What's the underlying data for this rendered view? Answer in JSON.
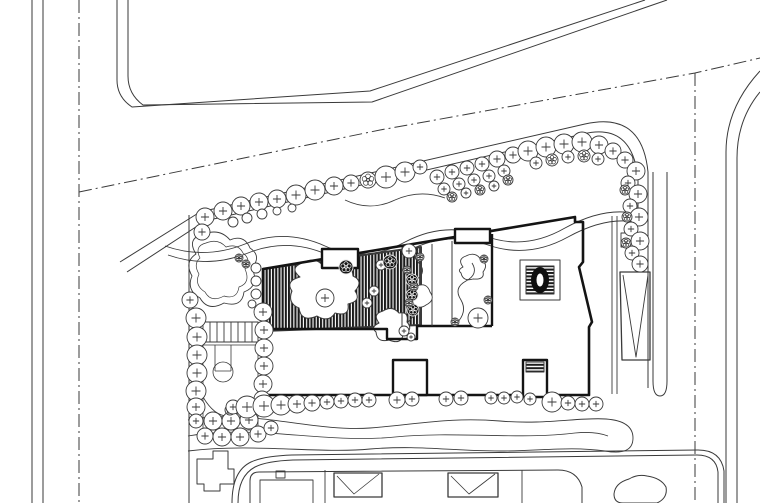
{
  "title": "architectural-site-plan",
  "canvas": {
    "width": 760,
    "height": 503,
    "background": "#ffffff",
    "ink": "#3a3a3a",
    "ink_bold": "#141414"
  },
  "layers": {
    "roads": [
      {
        "t": "p",
        "d": "M32,0 V503",
        "w": 1
      },
      {
        "t": "p",
        "d": "M43,0 V503",
        "w": 1
      },
      {
        "t": "p",
        "d": "M79,0 V503",
        "w": 1,
        "da": "13 4 2 4"
      },
      {
        "t": "p",
        "d": "M117,0 V80 Q117,97 132,107 L370,91 L645,0",
        "w": 1
      },
      {
        "t": "p",
        "d": "M128,0 V76 Q128,94 143,105 L372,102 L667,0",
        "w": 1
      },
      {
        "t": "p",
        "d": "M79,192 L380,130 L695,73 L760,58",
        "w": 1,
        "da": "13 4 2 4"
      },
      {
        "t": "p",
        "d": "M695,73 V503",
        "w": 1,
        "da": "13 4 2 4"
      },
      {
        "t": "p",
        "d": "M726,503 V152 Q726,108 760,71",
        "w": 1
      },
      {
        "t": "p",
        "d": "M737,503 V158 Q737,120 760,92",
        "w": 1
      }
    ],
    "site": [
      {
        "t": "p",
        "d": "M120,262 L200,212 L585,124 Q642,111 648,172 V388",
        "w": 1
      },
      {
        "t": "p",
        "d": "M127,272 L205,221 L583,134 Q632,122 638,178 V210",
        "w": 1
      },
      {
        "t": "p",
        "d": "M189,215 V503",
        "w": 1
      },
      {
        "t": "p",
        "d": "M612,216 V394",
        "w": 0.9
      },
      {
        "t": "p",
        "d": "M617,216 V394",
        "w": 0.9
      },
      {
        "t": "p",
        "d": "M653,172 V381 Q653,396 660,396 Q667,396 667,381 V172",
        "w": 1
      },
      {
        "t": "p",
        "d": "M620,272 H650 V360 H622 Z",
        "w": 1.3
      },
      {
        "t": "p",
        "d": "M623,275 L636,357 L648,275",
        "w": 0.9
      },
      {
        "t": "p",
        "d": "M203,322 H258 V342 H203 Z M210,322 V342 M217,322 V342 M224,322 V342 M231,322 V342 M238,322 V342 M245,322 V342 M252,322 V342",
        "w": 0.9
      },
      {
        "t": "p",
        "d": "M203,345 H258 V430 H203 Z",
        "w": 0.8
      },
      {
        "t": "p",
        "d": "M215,345 V371 M231,345 V371 M215,371 H231",
        "w": 0.8
      },
      {
        "t": "c",
        "cx": 223,
        "cy": 372,
        "r": 10,
        "w": 0.8
      },
      {
        "t": "p",
        "d": "M203,397 Q226,436 258,395",
        "w": 0.8
      },
      {
        "t": "p",
        "d": "M196,254 Q186,238 204,234 Q220,228 230,240 Q244,234 250,248 Q262,256 252,268 Q260,286 244,292 Q242,308 224,303 Q208,312 200,298 Q186,290 192,276 Q184,262 196,254 Z",
        "w": 0.9
      },
      {
        "t": "p",
        "d": "M200,258 Q194,246 206,243 Q218,238 226,247 Q238,243 243,253 Q252,260 245,269 Q251,283 239,287 Q237,300 224,296 Q211,303 205,292 Q194,285 199,274 Q193,264 200,258 Z",
        "w": 0.7
      },
      {
        "t": "p",
        "d": "M165,246 Q205,260 245,244 Q285,228 325,246 Q365,264 405,242 Q445,221 485,236 Q525,251 565,228 Q605,206 638,214",
        "w": 0.9
      },
      {
        "t": "p",
        "d": "M168,255 Q208,269 248,253 Q288,237 328,255 Q368,272 408,251 Q448,230 488,245 Q528,259 568,237 Q608,215 640,223",
        "w": 0.9
      },
      {
        "t": "p",
        "d": "M345,200 Q370,212 395,200 Q420,189 445,198",
        "w": 0.8
      },
      {
        "t": "p",
        "d": "M188,420 C250,408 310,432 370,428 C420,424 450,417 500,421 C545,425 580,417 606,419 Q633,421 633,438 Q633,456 605,451 C570,446 540,451 500,451 C450,451 420,445 370,449 C320,454 255,443 188,451",
        "w": 0.9
      },
      {
        "t": "p",
        "d": "M188,436 C255,424 325,444 395,437 C455,431 520,440 575,433 Q595,431 608,436",
        "w": 0.8
      },
      {
        "t": "p",
        "d": "M621,233 H639 V247 H621 Z",
        "w": 0.9
      }
    ],
    "building": [
      {
        "t": "p",
        "d": "M263,269 L421,247 L421,325 L263,331 Z",
        "w": 2,
        "f": "url(#vstripe)"
      },
      {
        "t": "p",
        "d": "M300,277 Q289,268 302,263 Q316,256 323,266 Q331,259 339,268 Q352,263 353,276 Q364,281 355,291 Q362,301 348,304 Q350,317 335,313 Q329,323 317,316 Q301,323 299,308 Q287,303 292,291 Q285,281 300,277 Z",
        "w": 1,
        "f": "#ffffff"
      },
      {
        "t": "p",
        "d": "M379,323 Q372,314 383,311 Q392,305 399,313 Q409,311 407,322 Q414,330 403,335 Q401,345 389,340 Q377,343 376,332 Q370,327 379,323 Z",
        "w": 1,
        "f": "#ffffff"
      },
      {
        "t": "p",
        "d": "M263,269 L575,217 V222 H583 V262 L579,267 L592,322 L589,327 V395 H263 Z",
        "w": 2.6,
        "bold": true
      },
      {
        "t": "p",
        "d": "M263,329 H387 V339 H417 V326 H492",
        "w": 2.4,
        "bold": true
      },
      {
        "t": "p",
        "d": "M402,247 V326",
        "w": 1
      },
      {
        "t": "p",
        "d": "M432,244 V326",
        "w": 1
      },
      {
        "t": "p",
        "d": "M452,241 V326",
        "w": 1
      },
      {
        "t": "p",
        "d": "M492,234 V326",
        "w": 2.4,
        "bold": true
      },
      {
        "t": "p",
        "d": "M322,249 H358 V268 H322 Z",
        "w": 2.4,
        "f": "#ffffff",
        "bold": true
      },
      {
        "t": "p",
        "d": "M455,229 H490 V243 H455 Z",
        "w": 2.4,
        "f": "#ffffff",
        "bold": true
      },
      {
        "t": "p",
        "d": "M393,360 H427 V395 H393 Z",
        "w": 2.4,
        "f": "#ffffff",
        "bold": true
      },
      {
        "t": "p",
        "d": "M523,360 H547 V397 H523 Z",
        "w": 2.4,
        "f": "#ffffff",
        "bold": true
      },
      {
        "t": "p",
        "d": "M526,362 H544 V372 H526 Z",
        "w": 1,
        "f": "url(#hstripe)"
      },
      {
        "t": "p",
        "d": "M520,260 H560 V300 H520 Z",
        "w": 1,
        "f": "#ffffff"
      },
      {
        "t": "p",
        "d": "M526,266 H554 V294 H526 Z",
        "w": 1,
        "f": "url(#hstripe)"
      },
      {
        "t": "e",
        "cx": 540,
        "cy": 280,
        "rx": 9,
        "ry": 13,
        "f": "#0f0f0f"
      },
      {
        "t": "e",
        "cx": 540,
        "cy": 280,
        "rx": 3.5,
        "ry": 6.5,
        "f": "#ffffff"
      },
      {
        "t": "p",
        "d": "M408,322 Q420,312 412,300 Q404,288 416,280 Q428,272 418,262 Q412,256 418,250",
        "w": 0.9
      },
      {
        "t": "p",
        "d": "M416,297 Q409,291 417,286 Q427,282 430,292 Q436,300 426,305 Q419,310 414,304 Q409,301 416,297 Z",
        "w": 0.9,
        "f": "#ffffff"
      },
      {
        "t": "p",
        "d": "M456,324 Q468,312 461,300 Q453,288 466,281 Q479,274 472,263",
        "w": 0.9
      },
      {
        "t": "p",
        "d": "M463,267 Q457,259 466,256 Q476,251 481,260 Q489,264 483,272 Q485,280 473,279 Q463,282 461,273 Q457,270 463,267 Z",
        "w": 0.9
      }
    ],
    "bottomBlock": [
      {
        "t": "p",
        "d": "M232,503 Q232,471 251,462 Q264,456 292,455 L698,450 Q721,450 724,471 V503",
        "w": 1
      },
      {
        "t": "p",
        "d": "M238,503 Q238,476 255,467 Q267,461 293,460 L697,455 Q716,455 718,472 V503",
        "w": 1
      },
      {
        "t": "p",
        "d": "M250,503 V481 Q250,472 259,472 L558,470 Q577,470 582,487 V503",
        "w": 1
      },
      {
        "t": "p",
        "d": "M260,503 V480 H313 V503",
        "w": 0.9
      },
      {
        "t": "p",
        "d": "M334,473 H382 V497 H334 Z",
        "w": 1.3
      },
      {
        "t": "p",
        "d": "M337,476 L354,494 L379,474",
        "w": 0.8
      },
      {
        "t": "p",
        "d": "M448,473 H498 V497 H448 Z",
        "w": 1.3
      },
      {
        "t": "p",
        "d": "M451,476 L469,494 L495,474",
        "w": 0.8
      },
      {
        "t": "p",
        "d": "M276,471 H285 V478 H276 Z",
        "w": 0.9
      },
      {
        "t": "p",
        "d": "M325,470 V503",
        "w": 0.9
      },
      {
        "t": "p",
        "d": "M522,470 V503",
        "w": 0.9
      },
      {
        "t": "p",
        "d": "M629,479 Q615,483 614,494 Q614,503 623,503 H657 Q668,498 666,487 Q661,478 647,476 Q637,474 629,479 Z",
        "w": 1
      },
      {
        "t": "p",
        "d": "M197,459 H213 V451 H228 V469 H234 V484 H220 V491 H204 V484 H197 Z",
        "w": 1
      }
    ],
    "trees": [
      [
        205,
        217,
        9
      ],
      [
        223,
        211,
        9
      ],
      [
        241,
        206,
        9
      ],
      [
        259,
        202,
        9
      ],
      [
        277,
        199,
        9
      ],
      [
        296,
        195,
        10
      ],
      [
        315,
        190,
        10
      ],
      [
        334,
        186,
        9
      ],
      [
        351,
        183,
        8
      ],
      [
        368,
        180,
        8,
        "flower"
      ],
      [
        386,
        177,
        11
      ],
      [
        405,
        172,
        10
      ],
      [
        420,
        167,
        7
      ],
      [
        233,
        222,
        5,
        "plain"
      ],
      [
        247,
        218,
        5,
        "plain"
      ],
      [
        262,
        214,
        5,
        "plain"
      ],
      [
        277,
        211,
        4,
        "plain"
      ],
      [
        292,
        208,
        4,
        "plain"
      ],
      [
        437,
        177,
        7
      ],
      [
        452,
        172,
        7
      ],
      [
        467,
        168,
        7
      ],
      [
        482,
        164,
        7
      ],
      [
        497,
        159,
        8
      ],
      [
        513,
        155,
        8
      ],
      [
        444,
        189,
        6
      ],
      [
        459,
        184,
        6
      ],
      [
        474,
        180,
        6
      ],
      [
        489,
        176,
        6
      ],
      [
        504,
        171,
        6
      ],
      [
        452,
        197,
        5,
        "flower"
      ],
      [
        466,
        193,
        5
      ],
      [
        480,
        190,
        5,
        "flower"
      ],
      [
        494,
        186,
        5
      ],
      [
        508,
        180,
        5,
        "flower"
      ],
      [
        528,
        151,
        10
      ],
      [
        546,
        147,
        10
      ],
      [
        564,
        144,
        10
      ],
      [
        582,
        142,
        10
      ],
      [
        599,
        145,
        9
      ],
      [
        613,
        151,
        8
      ],
      [
        536,
        163,
        6
      ],
      [
        552,
        160,
        6,
        "flower"
      ],
      [
        568,
        157,
        6
      ],
      [
        584,
        156,
        6,
        "flower"
      ],
      [
        598,
        159,
        6
      ],
      [
        625,
        160,
        8
      ],
      [
        636,
        171,
        9
      ],
      [
        628,
        183,
        7
      ],
      [
        638,
        194,
        9
      ],
      [
        630,
        206,
        7
      ],
      [
        639,
        217,
        9
      ],
      [
        631,
        229,
        7
      ],
      [
        640,
        241,
        9
      ],
      [
        632,
        253,
        7
      ],
      [
        640,
        264,
        8
      ],
      [
        625,
        190,
        5,
        "flower"
      ],
      [
        627,
        217,
        5,
        "flower"
      ],
      [
        626,
        243,
        5,
        "flower"
      ],
      [
        202,
        232,
        8
      ],
      [
        239,
        258,
        4,
        "flower"
      ],
      [
        246,
        264,
        4,
        "flower"
      ],
      [
        190,
        300,
        8
      ],
      [
        196,
        318,
        10
      ],
      [
        197,
        337,
        10
      ],
      [
        197,
        355,
        10
      ],
      [
        197,
        373,
        10
      ],
      [
        196,
        391,
        10
      ],
      [
        196,
        407,
        9
      ],
      [
        263,
        312,
        9
      ],
      [
        264,
        330,
        9
      ],
      [
        264,
        348,
        9
      ],
      [
        264,
        366,
        9
      ],
      [
        263,
        384,
        9
      ],
      [
        262,
        399,
        8
      ],
      [
        256,
        268,
        5,
        "plain"
      ],
      [
        256,
        281,
        5,
        "plain"
      ],
      [
        256,
        294,
        5,
        "plain"
      ],
      [
        252,
        304,
        4,
        "plain"
      ],
      [
        213,
        421,
        9
      ],
      [
        231,
        421,
        9
      ],
      [
        249,
        420,
        9
      ],
      [
        205,
        436,
        8
      ],
      [
        222,
        437,
        9
      ],
      [
        240,
        437,
        9
      ],
      [
        258,
        434,
        8
      ],
      [
        271,
        428,
        7
      ],
      [
        196,
        421,
        7
      ],
      [
        230,
        410,
        5,
        "flower"
      ],
      [
        252,
        409,
        5,
        "flower"
      ],
      [
        233,
        407,
        7
      ],
      [
        247,
        407,
        11
      ],
      [
        264,
        406,
        11
      ],
      [
        281,
        405,
        10
      ],
      [
        297,
        404,
        9
      ],
      [
        312,
        403,
        8
      ],
      [
        327,
        402,
        7
      ],
      [
        341,
        401,
        7
      ],
      [
        355,
        400,
        7
      ],
      [
        369,
        400,
        7
      ],
      [
        397,
        400,
        8
      ],
      [
        412,
        399,
        7
      ],
      [
        446,
        399,
        7
      ],
      [
        461,
        398,
        7
      ],
      [
        491,
        398,
        6
      ],
      [
        504,
        398,
        6
      ],
      [
        517,
        397,
        6
      ],
      [
        530,
        399,
        6
      ],
      [
        552,
        402,
        10
      ],
      [
        568,
        403,
        7
      ],
      [
        582,
        404,
        7
      ],
      [
        596,
        404,
        7
      ],
      [
        325,
        298,
        9
      ],
      [
        374,
        291,
        5
      ],
      [
        367,
        303,
        5
      ],
      [
        381,
        265,
        5
      ],
      [
        404,
        331,
        5
      ],
      [
        411,
        337,
        4
      ],
      [
        346,
        267,
        7,
        "flowerDark"
      ],
      [
        390,
        262,
        7,
        "flowerDark"
      ],
      [
        412,
        280,
        6,
        "flowerDark"
      ],
      [
        412,
        295,
        6,
        "flowerDark"
      ],
      [
        413,
        310,
        6,
        "flowerDark"
      ],
      [
        409,
        251,
        7
      ],
      [
        420,
        257,
        4,
        "flower"
      ],
      [
        407,
        270,
        4,
        "flower"
      ],
      [
        414,
        287,
        4,
        "flower"
      ],
      [
        409,
        303,
        4,
        "flower"
      ],
      [
        478,
        318,
        10
      ],
      [
        488,
        300,
        4,
        "flower"
      ],
      [
        455,
        322,
        4,
        "flower"
      ],
      [
        484,
        259,
        4,
        "flower"
      ]
    ]
  }
}
